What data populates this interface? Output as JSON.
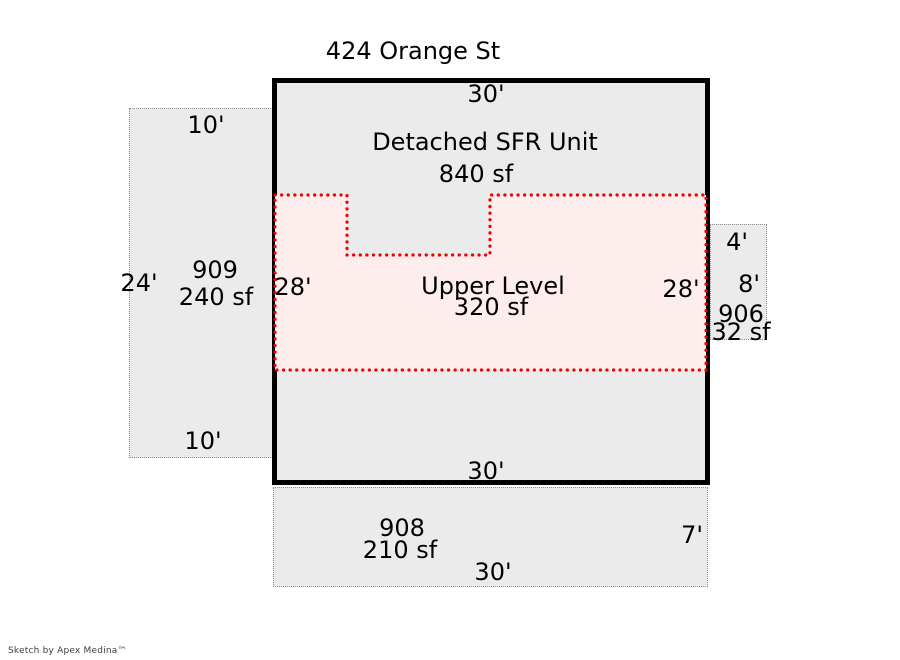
{
  "title": "424 Orange St",
  "footer": "Sketch by Apex Medina™",
  "colors": {
    "area_fill": "#ebebeb",
    "area_border": "#8f8f8f",
    "building_border": "#000000",
    "upper_fill": "#fdeeed",
    "upper_border": "#f10000",
    "text": "#000000"
  },
  "building": {
    "label": "Detached SFR Unit",
    "area": "840 sf",
    "top_dim": "30'",
    "bottom_dim": "30'"
  },
  "upper_level": {
    "label": "Upper Level",
    "area": "320 sf",
    "left_dim": "28'",
    "right_dim": "28'"
  },
  "unit_909": {
    "id": "909",
    "area": "240 sf",
    "top_dim": "10'",
    "bottom_dim": "10'",
    "left_dim": "24'"
  },
  "unit_906": {
    "id": "906",
    "area": "32 sf",
    "top_dim": "4'",
    "right_dim": "8'"
  },
  "unit_908": {
    "id": "908",
    "area": "210 sf",
    "bottom_dim": "30'",
    "right_dim": "7'"
  }
}
